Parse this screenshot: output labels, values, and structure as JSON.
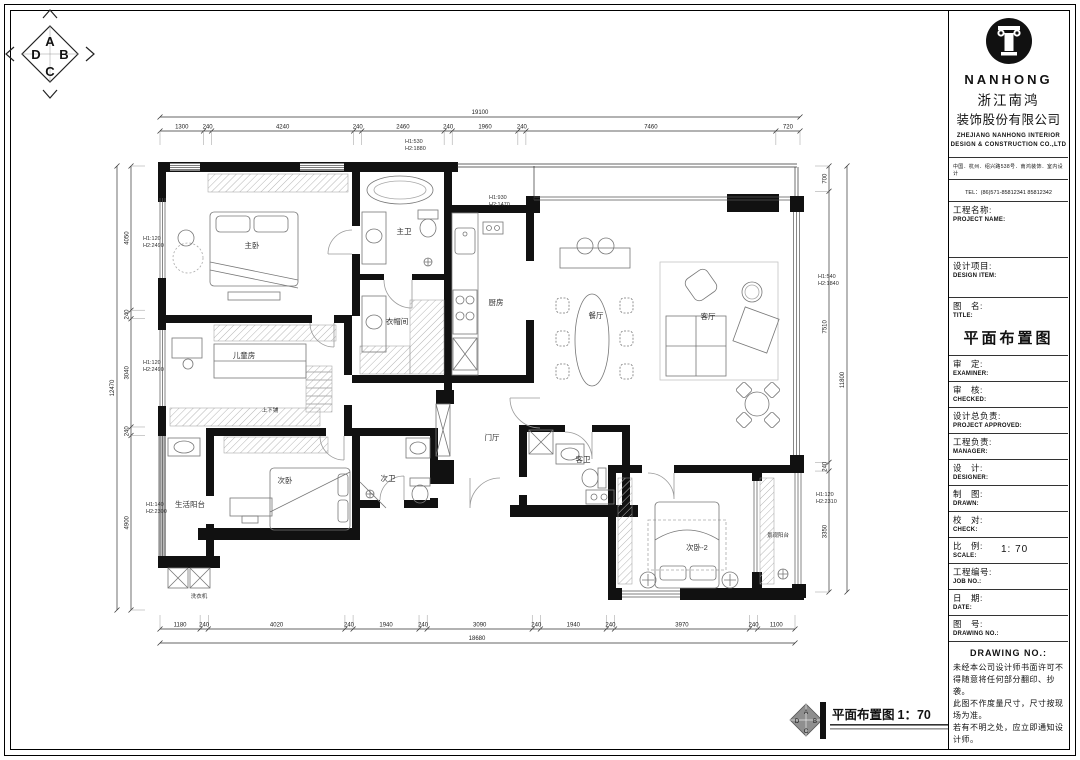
{
  "sheet": {
    "compass": {
      "top": "A",
      "right": "B",
      "bottom": "C",
      "left": "D"
    },
    "footer": {
      "label": "平面布置图",
      "scale": "1：70",
      "marker": {
        "top": "A",
        "right": "B",
        "bottom": "C",
        "left": "D"
      }
    }
  },
  "rooms": {
    "master_bedroom": "主卧",
    "master_bath": "主卫",
    "cloakroom": "衣帽间",
    "kitchen": "厨房",
    "dining": "餐厅",
    "living": "客厅",
    "kids_room": "儿童房",
    "bunk_bed": "上下铺",
    "bedroom2": "次卧",
    "bath2": "次卫",
    "laundry_balcony": "生活阳台",
    "washer": "洗衣机",
    "foyer": "门厅",
    "guest_bath": "客卫",
    "bedroom3": "次卧-2",
    "view_balcony": "景观阳台"
  },
  "dimensions": {
    "top": {
      "total": "19100",
      "segments": [
        "1300",
        "240",
        "4240",
        "240",
        "2460",
        "240",
        "1960",
        "240",
        "7460",
        "720"
      ]
    },
    "bottom": {
      "total": "18680",
      "segments": [
        "1180",
        "240",
        "4020",
        "240",
        "1940",
        "240",
        "3090",
        "240",
        "1940",
        "240",
        "3970",
        "240",
        "1100"
      ]
    },
    "left": {
      "total": "12470",
      "segments": [
        "4050",
        "240",
        "3040",
        "240",
        "4900"
      ]
    },
    "right": {
      "total": "11800",
      "segments": [
        "700",
        "7510",
        "240",
        "3350"
      ]
    },
    "annotations": [
      "H1:530 H2:1880",
      "H1:930 H2:1470",
      "H1:120 H2:2490",
      "H1:120 H2:2490",
      "H1:140 H2:2300",
      "H1:540 H2:1840",
      "H1:120 H2:2310"
    ]
  },
  "company": {
    "name_en": "NANHONG",
    "name_cn_line1": "浙江南鸿",
    "name_cn_line2": "装饰股份有限公司",
    "sub_en": "ZHEJIANG NANHONG INTERIOR DESIGN & CONSTRUCTION CO.,LTD",
    "address": "中国．杭州．绍兴路538号．南鸿装饰．室内设计",
    "tel": "TEL：(86)571-85812341  85812342"
  },
  "title_block": {
    "project_name": {
      "cn": "工程名称:",
      "en": "PROJECT NAME:"
    },
    "design_item": {
      "cn": "设计项目:",
      "en": "DESIGN ITEM:"
    },
    "drawing_title": {
      "cn": "图　名:",
      "en": "TITLE:",
      "value": "平面布置图"
    },
    "examiner": {
      "cn": "审　定:",
      "en": "EXAMINER:"
    },
    "checked": {
      "cn": "审　核:",
      "en": "CHECKED:"
    },
    "project_approved": {
      "cn": "设计总负责:",
      "en": "PROJECT APPROVED:"
    },
    "manager": {
      "cn": "工程负责:",
      "en": "MANAGER:"
    },
    "designer": {
      "cn": "设　计:",
      "en": "DESIGNER:"
    },
    "drawn": {
      "cn": "制　图:",
      "en": "DRAWN:"
    },
    "check": {
      "cn": "校　对:",
      "en": "CHECK:"
    },
    "scale": {
      "cn": "比　例:",
      "en": "SCALE:",
      "value": "1: 70"
    },
    "job_no": {
      "cn": "工程编号:",
      "en": "JOB NO.:"
    },
    "date": {
      "cn": "日　期:",
      "en": "DATE:"
    },
    "drawing_no": {
      "cn": "图　号:",
      "en": "DRAWING NO.:"
    },
    "notes_header": "DRAWING NO.:",
    "notes": "未经本公司设计师书面许可不得随意将任何部分翻印、抄袭。\n此图不作度量尺寸，尺寸按现场为准。\n若有不明之处，应立即通知设计师。"
  }
}
